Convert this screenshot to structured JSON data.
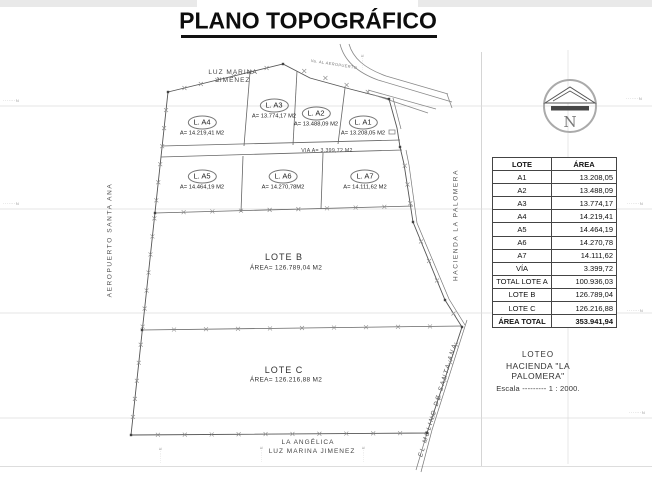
{
  "title": "PLANO TOPOGRÁFICO",
  "map": {
    "neighbors": {
      "top_line1": "LUZ  MARINA",
      "top_line2": "JIMENEZ",
      "left": "AEROPUERTO SANTA ANA",
      "right": "HACIENDA  LA  PALOMERA",
      "bottom_diag": "EL MOLINO DE SANTA ANA",
      "bottom_line1": "LA ANGÉLICA",
      "bottom_line2": "LUZ  MARINA  JIMENEZ"
    },
    "road_label": "Va. AL AEROPUERTO",
    "via_label": "VIA A= 3.399,72 M2",
    "lots": [
      {
        "id": "a4",
        "name": "L. A4",
        "area": "A= 14.219,41 M2"
      },
      {
        "id": "a3",
        "name": "L. A3",
        "area": "A= 13.774,17 M2"
      },
      {
        "id": "a2",
        "name": "L. A2",
        "area": "A= 13.488,09 M2"
      },
      {
        "id": "a1",
        "name": "L. A1",
        "area": "A= 13.208,05 M2"
      },
      {
        "id": "a5",
        "name": "L. A5",
        "area": "A= 14.464,19 M2"
      },
      {
        "id": "a6",
        "name": "L. A6",
        "area": "A= 14.270,78M2"
      },
      {
        "id": "a7",
        "name": "L. A7",
        "area": "A= 14.111,62 M2"
      }
    ],
    "lot_b": {
      "name": "LOTE B",
      "area": "ÁREA= 126.789,04 M2"
    },
    "lot_c": {
      "name": "LOTE C",
      "area": "ÁREA= 126.216,88 M2"
    },
    "compass_letter": "N"
  },
  "table": {
    "headers": [
      "LOTE",
      "ÁREA"
    ],
    "rows": [
      [
        "A1",
        "13.208,05"
      ],
      [
        "A2",
        "13.488,09"
      ],
      [
        "A3",
        "13.774,17"
      ],
      [
        "A4",
        "14.219,41"
      ],
      [
        "A5",
        "14.464,19"
      ],
      [
        "A6",
        "14.270,78"
      ],
      [
        "A7",
        "14.111,62"
      ],
      [
        "VÍA",
        "3.399,72"
      ],
      [
        "TOTAL LOTE A",
        "100.936,03"
      ],
      [
        "LOTE B",
        "126.789,04"
      ],
      [
        "LOTE C",
        "126.216,88"
      ]
    ],
    "total_row": [
      "ÁREA TOTAL",
      "353.941,94"
    ]
  },
  "title_block": {
    "line1": "LOTEO",
    "line2": "HACIENDA  \"LA PALOMERA\"",
    "scale": "Escala  ---------  1 : 2000."
  },
  "grid_labels": {
    "left": [
      "·······N",
      "·······N"
    ],
    "right": [
      "·······N",
      "·······N",
      "·······N",
      "·······N"
    ],
    "bottom": [
      "·······E",
      "·······E",
      "·······E"
    ],
    "top": [
      "·······E"
    ]
  }
}
